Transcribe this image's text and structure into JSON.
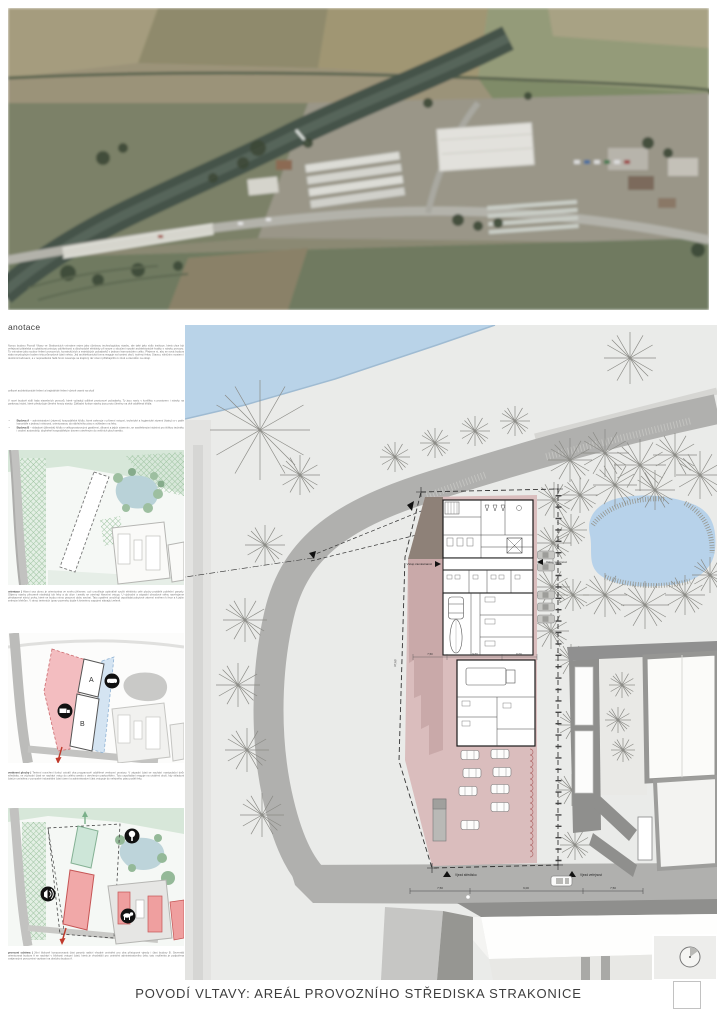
{
  "title": "POVODÍ VLTAVY: AREÁL PROVOZNÍHO STŘEDISKA STRAKONICE",
  "annotation": {
    "heading": "anotace",
    "para1": "Novou budovu Povodí Vltavy ve Strakonicích vnímáme nejen jako účelovou technologickou stavbu, ale také jako sídlo instituce, která chce být veřejnosti přátelská a uplatňovat principy udržitelnosti a dlouhodobé efektivity při snaze o sloučení vysoké architektonické kvality s nároky provozu. To vnímáme jako soubor řešení provozních, konstrukčních a estetických požadavků v jednom harmonickém celku. Přejeme si, aby se nová budova stala smysluplným bodem této průmyslové části města. Její architektonická forma reaguje na kontext okolí, tvořený řekou Otavou, silničním mostem i okolními budovami, a v nepravidelné řadě hmot navazuje na krajinný ráz území přiléhajícího k zóně a závodům na okraji.",
    "subheading": "celkové architektonické řešení a krajinářské řešení včetně vazeb na okolí",
    "para2": "V nové budově sídlí řada stavebních provozů, které vyžadují odlišné prostorové požadavky. Ty jsou navíc v konfliktu s prostorem i nároky na parkovací stání, které předurčuje členění hmoty stavby. Základní funkce stavby jsou proto členěny na dvě oddělená křídla:",
    "bullets": [
      {
        "label": "Budova A",
        "text": "– administrativní (zázemí) hospodářské křídlo, které zahrnuje v přízemí vstupní, technické a hygienické zázemí (šatny) a v patře kanceláře s jednací místností, orientovanou do nábřežního pásu s výhledem na řeku."
      },
      {
        "label": "Budova B",
        "text": "– skladové (dílenské) křídlo s velkoprostorovými garážemi, dílnami a jejich zázemím, se zastřešenými stáními pro těžkou techniku i osobní automobily, doplněné hospodářským dvorem otevřeným do vnitřních ploch areálu."
      }
    ]
  },
  "diagrams": [
    {
      "label": "orientace |",
      "text": "Hlavní osa domu je orientována ve směru jih/sever, což umožňuje optimálně využít efektivitu celé plochy protáhlé pobřežní parcely. Objemy stavby přirozeně následují tok řeky a do ulice i areálu se otevírají hlavními vstupy. U východní a západní obvodové stěny navrhujeme předsazené stínicí prvky, které se budou mimo pracovní dobu zavírat. Tato opatření umožňují uspořádat pobytové zázemí směrem k řece a k jejím zeleným břehům. V rámci terénních úprav pozemku dojde k šetrnému zapojení stávající zeleně."
    },
    {
      "label": "venkovní plochy |",
      "text": "Terénní rozvržení funkcí vytváří dva programově oddělené venkovní prostory. V západní části se nachází manipulační dvůr střediska, ve východní části se nachází vstup do celého areálu s otevřeným parkovištěm. Toto uspořádání reaguje na utváření okolí, kdy skladová část je umístěna v pomyslné industriální části území a administrativní část vstupuje do veřejného pásu podél řeky."
    },
    {
      "label": "provozní schéma |",
      "text": "Jižní blokově komponovaná část parcely nabízí vhodné umístění pro oba přístupové vjezdy i část budovy B. Severněji orientovaná budova A se nachází v blízkosti vstupní části, která je vhodnější pro umístění administrativního čela; tato myšlenka je podpořena vzájemnými provozními vazbami na obsluhu budovy A."
    }
  ],
  "diagram2": {
    "building_a": "A",
    "building_b": "B"
  },
  "site_plan": {
    "entrance_west": "Vstup zaměstnanci",
    "entrance_east": "Vstup veřejnost",
    "gate_west": "Vjezd středisko",
    "gate_east": "Vjezd veřejnost",
    "road_dims": [
      "7,50",
      "9,00",
      "7,50"
    ],
    "building_dims": [
      "7,50",
      "9,60",
      "6,00"
    ],
    "side_dim": "37,60"
  },
  "colors": {
    "water": "#b9d3e8",
    "pond": "#b7d2ea",
    "road": "#b0b0ae",
    "site_pink": "#dabdbd",
    "building_red": "#f1a8a8",
    "zone_red": "#f3bdc0",
    "zone_blue": "#d4e4f2",
    "green_hatch": "#9fc4a2",
    "wall_gray": "#8f8f8d"
  }
}
